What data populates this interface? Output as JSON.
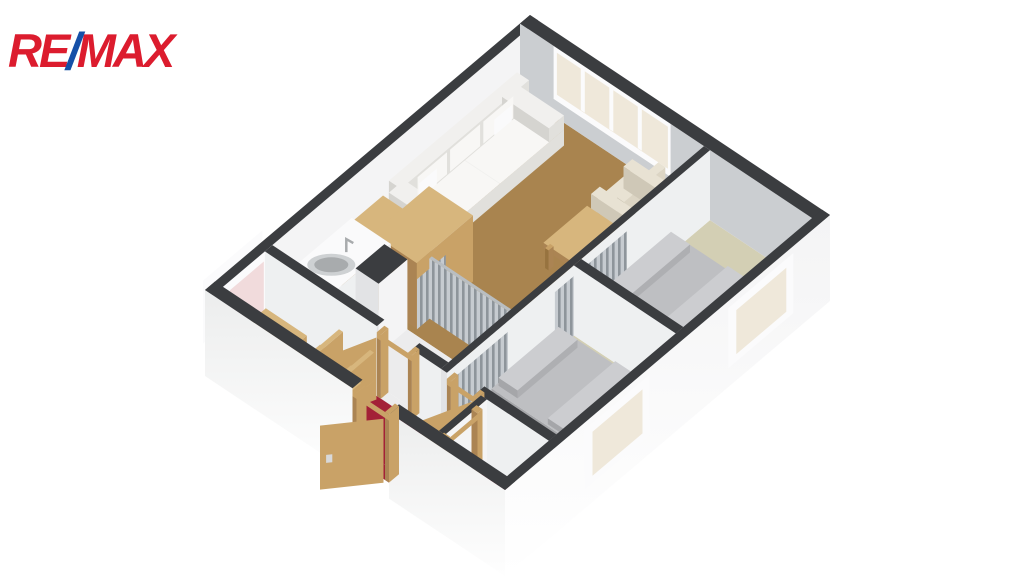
{
  "brand": {
    "re": "RE",
    "slash": "/",
    "max": "MAX",
    "red": "#dc1c2e",
    "blue": "#1550a8"
  },
  "colors": {
    "cap": "#3b3d40",
    "wall_in_left": "#f4f4f5",
    "wall_in_back": "#cbced1",
    "wall_soft": "#eef0f1",
    "wall_end": "#e2e3e5",
    "cork": "#a9844f",
    "beige": "#d3cfb4",
    "red_floor": "#a32137",
    "kitchen_floor": "#ececed",
    "wood": "#c9a267",
    "wood_light": "#d7b67d",
    "wood_dark": "#ab8453",
    "wood_leg": "#97733f",
    "white": "#f4f4f5",
    "white_top": "#fafafb",
    "sofa_top": "#f1f0ee",
    "sofa_front": "#e1e0dc",
    "sofa_side": "#d5d4d0",
    "cushion": "#f8f7f5",
    "cream_top": "#e8e2d3",
    "cream_front": "#dcd5c4",
    "cream_side": "#cfc8b7",
    "bed_top": "#bebfc2",
    "bed_se": "#aeafb2",
    "bed_sw": "#a5a6a9",
    "bed_light": "#cccdd0",
    "frame": "#fbfbfc",
    "glass_cream": "#efe8da",
    "glass_pink": "#f1dbdc",
    "steel_rim": "#ced1d3",
    "steel_basin": "#a8abad",
    "handle": "#d8d9da"
  }
}
